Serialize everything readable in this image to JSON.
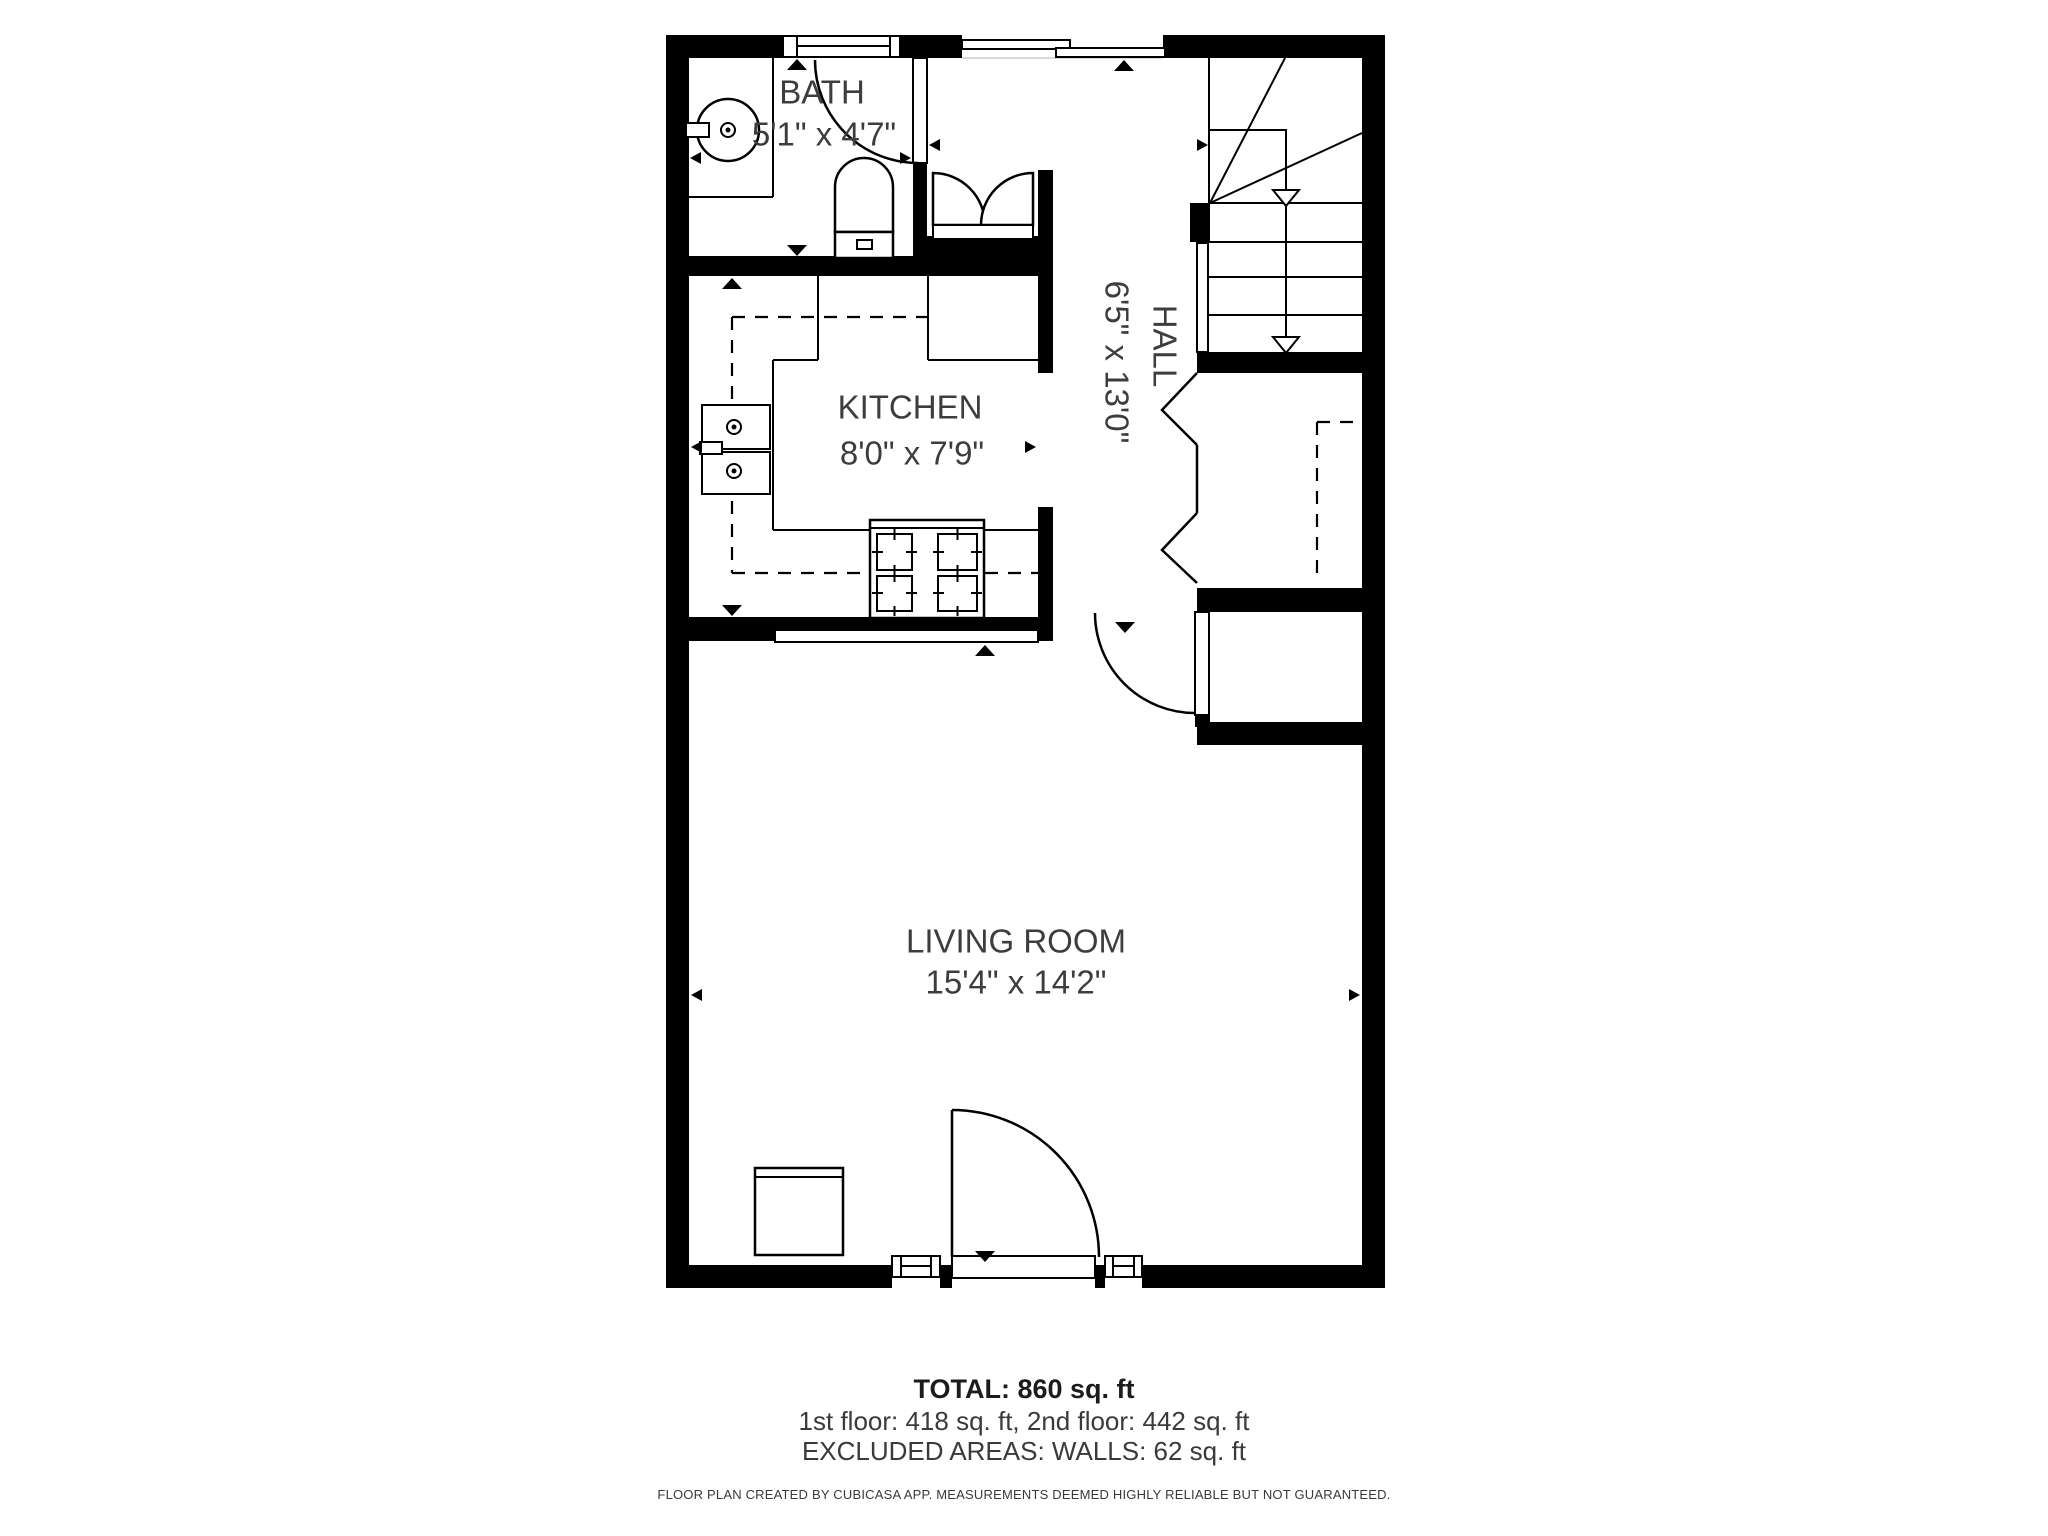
{
  "plan": {
    "rooms": [
      {
        "name": "BATH",
        "dimensions": "5'1\" x 4'7\""
      },
      {
        "name": "KITCHEN",
        "dimensions": "8'0\" x 7'9\""
      },
      {
        "name": "HALL",
        "dimensions": "6'5\" x 13'0\""
      },
      {
        "name": "LIVING ROOM",
        "dimensions": "15'4\" x 14'2\""
      }
    ],
    "fixtures": [
      "bathroom-round-sink",
      "toilet",
      "bath-swing-door",
      "double-door-closet",
      "kitchen-double-sink",
      "stove-four-burners",
      "counter-dashed-outline",
      "winder-staircase-down",
      "under-stair-closet-bifold-doors",
      "entry-closet-swing-door",
      "front-door",
      "appliance-cabinet",
      "windows",
      "measurement-arrows"
    ],
    "colors": {
      "wall": "#000000",
      "line": "#000000",
      "label_text": "#3d3d3d",
      "background": "#ffffff"
    }
  },
  "summary": {
    "total": "TOTAL: 860 sq. ft",
    "floors": "1st floor: 418 sq. ft, 2nd floor: 442 sq. ft",
    "excluded": "EXCLUDED AREAS: WALLS: 62 sq. ft",
    "disclaimer": "FLOOR PLAN CREATED BY CUBICASA APP. MEASUREMENTS DEEMED HIGHLY RELIABLE BUT NOT GUARANTEED."
  }
}
